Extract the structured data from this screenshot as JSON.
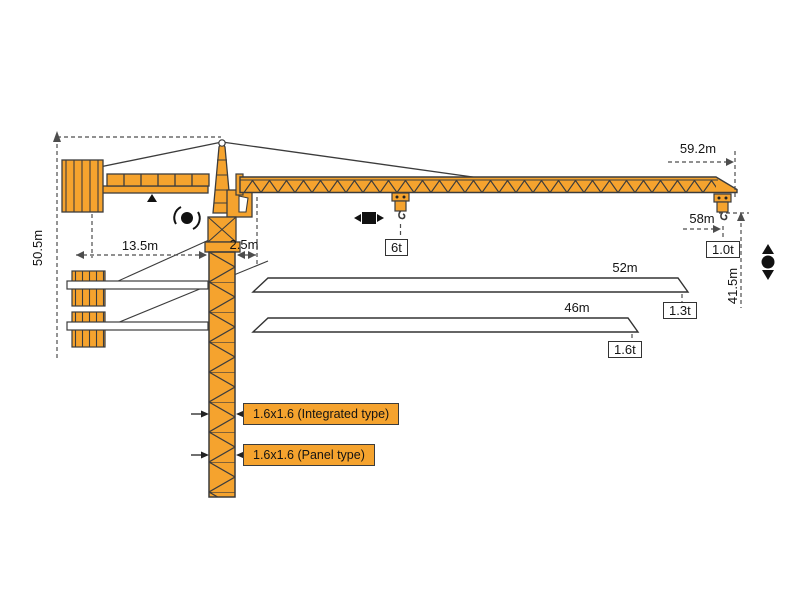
{
  "figure": {
    "kind": "tower-crane-dimension-diagram"
  },
  "colors": {
    "crane_orange": "#F5A32E",
    "outline": "#3C3C3C",
    "dim_line": "#4D4D4D",
    "symbol_black": "#111111"
  },
  "dims": {
    "total_height": "50.5m",
    "counter_jib": "13.5m",
    "jib_offset": "2.5m",
    "tip_radius": "59.2m",
    "max_radius": "58m",
    "hook_height": "41.5m"
  },
  "loads": {
    "mid": "6t",
    "tip_main": "1.0t"
  },
  "variants": [
    {
      "length": "52m",
      "tip_load": "1.3t"
    },
    {
      "length": "46m",
      "tip_load": "1.6t"
    }
  ],
  "mast_types": [
    {
      "label": "1.6x1.6 (Integrated type)"
    },
    {
      "label": "1.6x1.6 (Panel type)"
    }
  ]
}
